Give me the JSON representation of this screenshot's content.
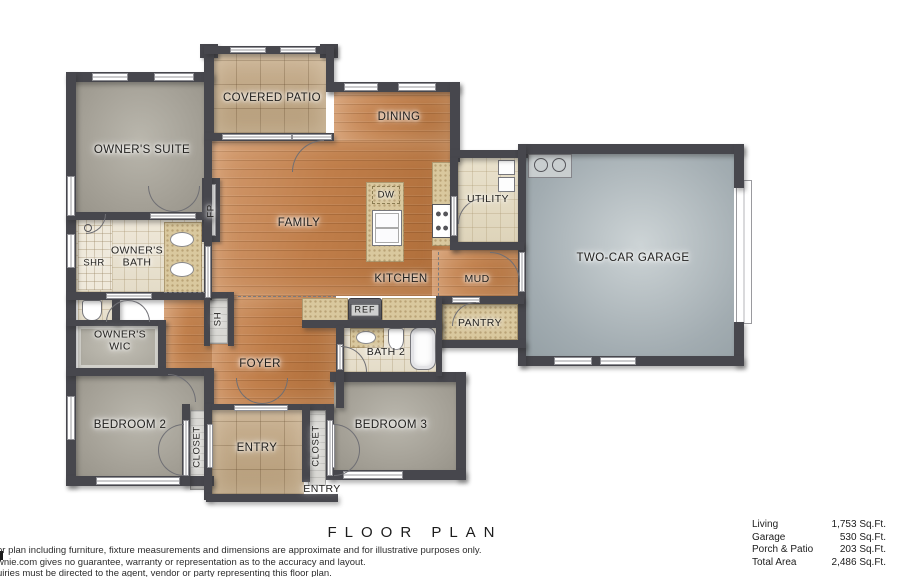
{
  "title": "FLOOR PLAN",
  "footer": {
    "disclaimer_lines": [
      "or plan including furniture, fixture measurements and dimensions are approximate and for illustrative purposes only.",
      "wnie.com gives no guarantee, warranty or representation as to the accuracy and layout.",
      "uiries must be directed to the agent, vendor or party representing this floor plan."
    ],
    "area_table": {
      "rows": [
        {
          "label": "Living",
          "value": "1,753 Sq.Ft."
        },
        {
          "label": "Garage",
          "value": "530 Sq.Ft."
        },
        {
          "label": "Porch & Patio",
          "value": "203 Sq.Ft."
        },
        {
          "label": "Total Area",
          "value": "2,486 Sq.Ft."
        }
      ]
    }
  },
  "plan": {
    "colors": {
      "wall": "#47474d",
      "wood_floor": "#c08050",
      "carpet": "#a6a39a",
      "patio_tile": "#c2ab89",
      "bath_tile": "#eae3d3",
      "concrete": "#a4adb2"
    },
    "labels": [
      {
        "id": "owners-suite",
        "text": "OWNER'S SUITE",
        "x": 142,
        "y": 151,
        "kind": "room"
      },
      {
        "id": "covered-patio",
        "text": "COVERED PATIO",
        "x": 272,
        "y": 99,
        "kind": "room"
      },
      {
        "id": "dining",
        "text": "DINING",
        "x": 399,
        "y": 118,
        "kind": "room"
      },
      {
        "id": "family",
        "text": "FAMILY",
        "x": 299,
        "y": 224,
        "kind": "room"
      },
      {
        "id": "utility",
        "text": "UTILITY",
        "x": 488,
        "y": 199,
        "kind": "room-sm"
      },
      {
        "id": "two-car-garage",
        "text": "TWO-CAR GARAGE",
        "x": 633,
        "y": 259,
        "kind": "room"
      },
      {
        "id": "dw",
        "text": "DW",
        "x": 386,
        "y": 195,
        "kind": "tag"
      },
      {
        "id": "shr",
        "text": "SHR",
        "x": 94,
        "y": 263,
        "kind": "tag"
      },
      {
        "id": "owners-bath",
        "text": "OWNER'S\nBATH",
        "x": 137,
        "y": 257,
        "kind": "room-sm"
      },
      {
        "id": "kitchen",
        "text": "KITCHEN",
        "x": 401,
        "y": 280,
        "kind": "room"
      },
      {
        "id": "mud",
        "text": "MUD",
        "x": 477,
        "y": 279,
        "kind": "room-sm"
      },
      {
        "id": "fp",
        "text": "FP",
        "x": 211,
        "y": 211,
        "kind": "vtag"
      },
      {
        "id": "owners-wic",
        "text": "OWNER'S\nWIC",
        "x": 120,
        "y": 341,
        "kind": "room-sm"
      },
      {
        "id": "pantry",
        "text": "PANTRY",
        "x": 480,
        "y": 323,
        "kind": "room-sm"
      },
      {
        "id": "ref",
        "text": "REF",
        "x": 365,
        "y": 310,
        "kind": "ref"
      },
      {
        "id": "sh",
        "text": "SH",
        "x": 218,
        "y": 319,
        "kind": "vtag"
      },
      {
        "id": "foyer",
        "text": "FOYER",
        "x": 260,
        "y": 365,
        "kind": "room"
      },
      {
        "id": "bath-2",
        "text": "BATH 2",
        "x": 386,
        "y": 352,
        "kind": "room-sm"
      },
      {
        "id": "bedroom-2",
        "text": "BEDROOM 2",
        "x": 130,
        "y": 426,
        "kind": "room"
      },
      {
        "id": "closet-left",
        "text": "CLOSET",
        "x": 197,
        "y": 447,
        "kind": "vtag"
      },
      {
        "id": "entry",
        "text": "ENTRY",
        "x": 257,
        "y": 449,
        "kind": "room"
      },
      {
        "id": "closet-right",
        "text": "CLOSET",
        "x": 316,
        "y": 446,
        "kind": "vtag"
      },
      {
        "id": "bedroom-3",
        "text": "BEDROOM 3",
        "x": 391,
        "y": 426,
        "kind": "room"
      },
      {
        "id": "entry-porch",
        "text": "ENTRY",
        "x": 322,
        "y": 489,
        "kind": "room-sm"
      }
    ]
  }
}
